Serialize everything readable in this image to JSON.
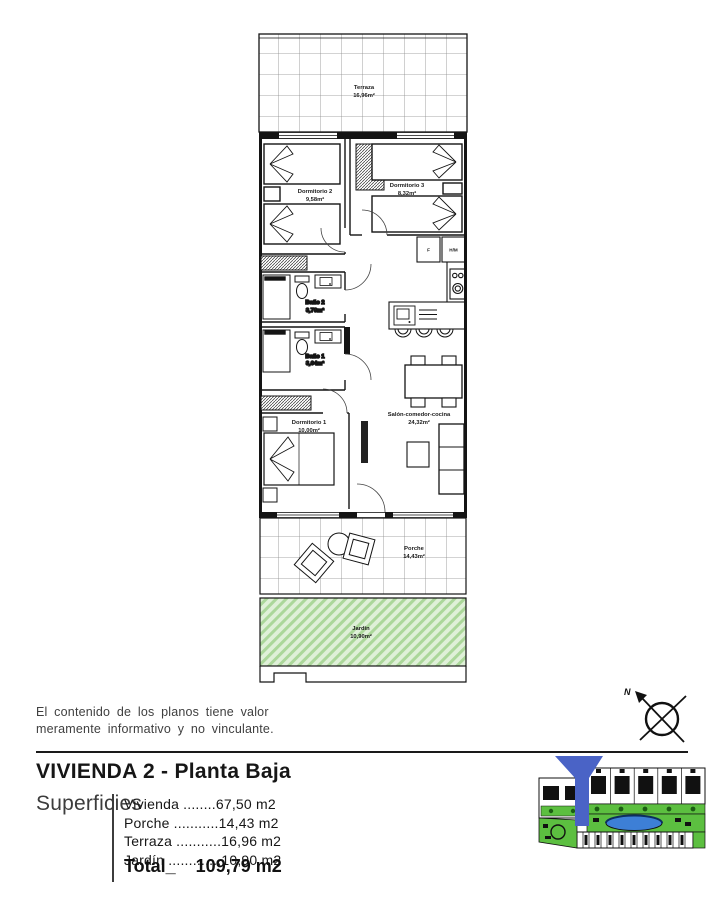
{
  "plan": {
    "rooms": {
      "terraza": {
        "name": "Terraza",
        "area": "16,96m²"
      },
      "dormitorio2": {
        "name": "Dormitorio 2",
        "area": "9,58m²"
      },
      "dormitorio3": {
        "name": "Dormitorio 3",
        "area": "8,32m²"
      },
      "bano2": {
        "name": "Baño 2",
        "area": "3,78m²"
      },
      "bano1": {
        "name": "Baño 1",
        "area": "3,64m²"
      },
      "dormitorio1": {
        "name": "Dormitorio 1",
        "area": "10,00m²"
      },
      "salon": {
        "name": "Salón-comedor-cocina",
        "area": "24,32m²"
      },
      "porche": {
        "name": "Porche",
        "area": "14,43m²"
      },
      "jardin": {
        "name": "Jardín",
        "area": "10,90m²"
      }
    },
    "kitchen": {
      "fridge_label": "F",
      "washer_label": "H/M"
    },
    "compass_label": "N"
  },
  "disclaimer": {
    "line1": "El contenido de los planos tiene valor",
    "line2": "meramente informativo y no vinculante."
  },
  "footer": {
    "title": "VIVIENDA 2 - Planta Baja",
    "superficies_heading": "Superficies",
    "items": [
      "Vivienda ........67,50 m2",
      "Porche ...........14,43 m2",
      "Terraza ...........16,96 m2",
      "Jardín .............10,90 m2"
    ],
    "total_label": "Total_",
    "total_value": "109,79 m2"
  },
  "colors": {
    "garden_green": "#dff0d8",
    "garden_hatch": "#abd79a",
    "map_green": "#5cbf40",
    "pool_blue": "#3d7fd6",
    "marker_blue": "#4a63c6"
  }
}
